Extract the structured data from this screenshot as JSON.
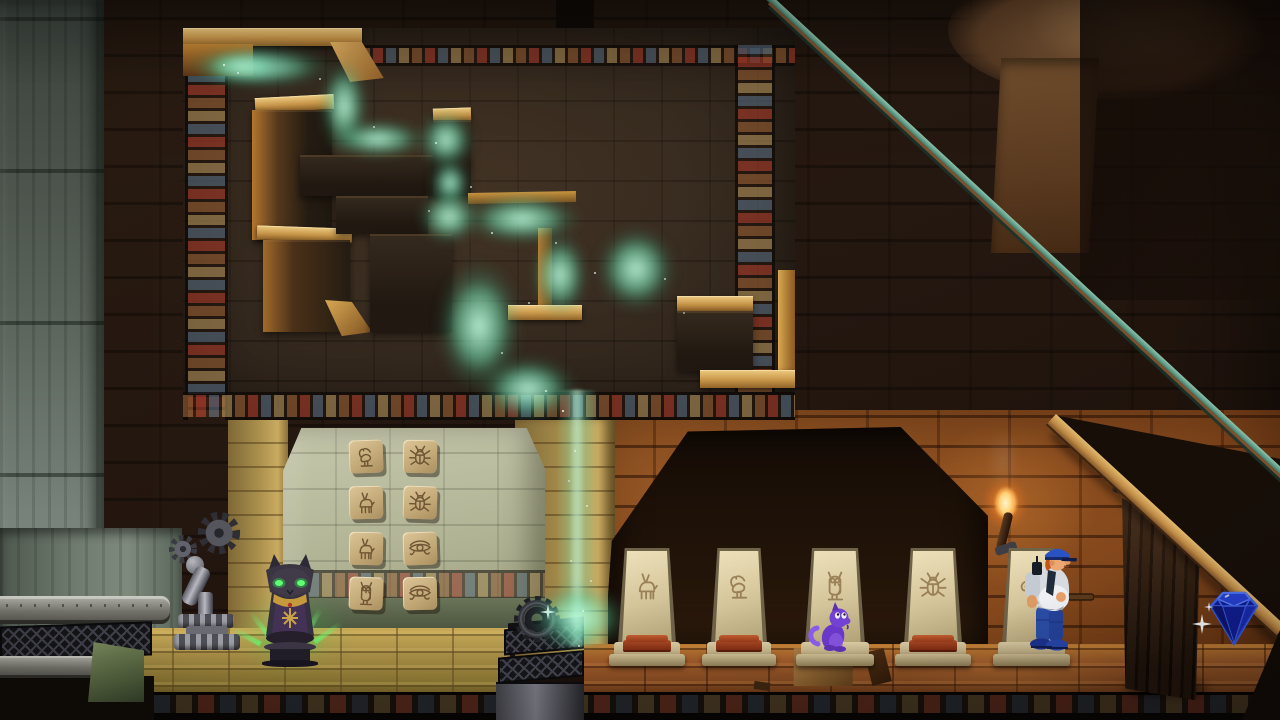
{
  "scene": {
    "name": "egyptian-tomb-puzzle-room",
    "viewport": {
      "width": 1280,
      "height": 720
    }
  },
  "palette": {
    "mist": "#5fd8a8",
    "maze_gold": "#d9b468",
    "maze_stone": "#362c23",
    "wall_dark": "#241812",
    "wall_orange": "#8a4e20",
    "alcove_wall": "#bdbfa3",
    "floor_sand": "#a88e46",
    "floor_clay": "#96572a",
    "gem_blue": "#2038c8",
    "idol_glow": "#52e45e",
    "flame_orange": "#ff9a30",
    "railing_teal": "#6aa892",
    "beam_wood": "#c99a54",
    "cushion_red": "#9c3c1c",
    "creature_purple": "#7442d2",
    "officer_uniform_blue": "#2a52c2"
  },
  "maze": {
    "kind": "mist-maze",
    "mist_color_name": "green",
    "flow": "top-left-to-bottom-center-stream"
  },
  "tile_wall": {
    "rows": [
      {
        "cells": [
          {
            "glyph": "ibis"
          },
          {
            "glyph": "scarab"
          }
        ]
      },
      {
        "cells": [
          {
            "glyph": "gazelle"
          },
          {
            "glyph": "scarab"
          }
        ]
      },
      {
        "cells": [
          {
            "glyph": "gazelle"
          },
          {
            "glyph": "horus-eye"
          }
        ]
      },
      {
        "cells": [
          {
            "glyph": "owl"
          },
          {
            "glyph": "horus-eye"
          }
        ]
      }
    ]
  },
  "steles": [
    {
      "glyph": "gazelle",
      "cushion": true,
      "occupant": null
    },
    {
      "glyph": "ibis",
      "cushion": true,
      "occupant": null
    },
    {
      "glyph": "owl",
      "cushion": false,
      "occupant": "purple-cat"
    },
    {
      "glyph": "scarab",
      "cushion": true,
      "occupant": null
    },
    {
      "glyph": "swirl",
      "cushion": false,
      "occupant": "police-officer"
    }
  ],
  "objects": {
    "cat_idol": {
      "name": "bastet-idol",
      "eyes": "glowing-green",
      "aura": "green-rays"
    },
    "gear_wheel": {
      "name": "gear-wheel",
      "sparkle": true
    },
    "mist_stream": {
      "name": "mist-stream",
      "lands_on": "grate-box"
    },
    "grate_box": {
      "name": "grate-box"
    },
    "wall_vent": {
      "name": "wall-vent"
    },
    "valve": {
      "name": "pipe-valve-machine"
    },
    "torch": {
      "name": "wall-torch",
      "lit": true
    },
    "door": {
      "name": "wooden-plank-door"
    },
    "gem": {
      "name": "blue-gem",
      "sparkle": true
    },
    "officer": {
      "name": "police-officer",
      "facing": "right",
      "holding": "club"
    },
    "creature": {
      "name": "purple-cat",
      "facing": "right"
    },
    "stair": {
      "name": "stair-ramp",
      "railing": "teal"
    }
  }
}
